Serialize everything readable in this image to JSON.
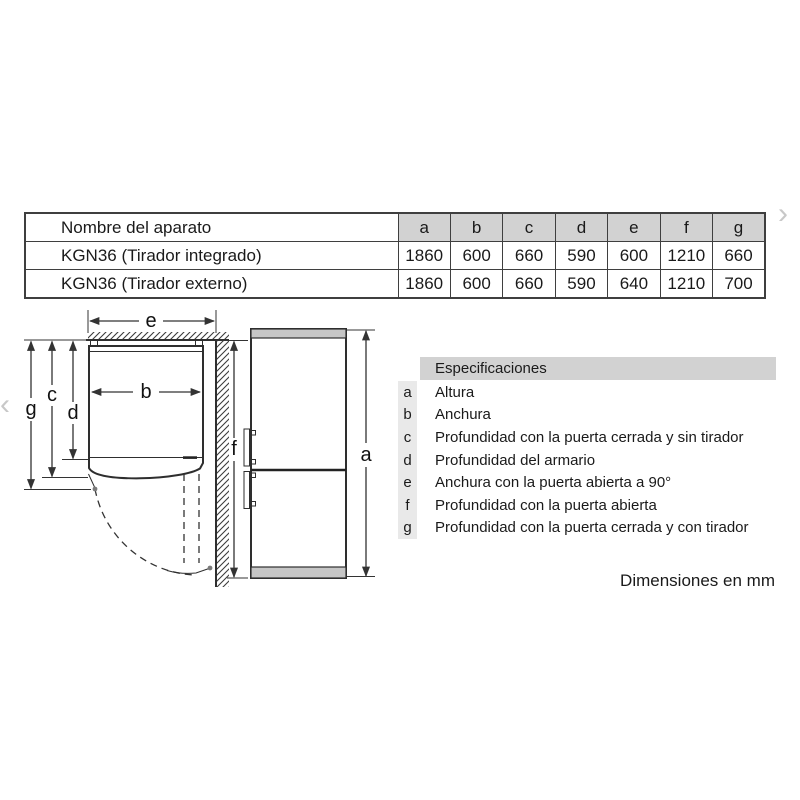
{
  "table": {
    "name_header": "Nombre del aparato",
    "dim_headers": [
      "a",
      "b",
      "c",
      "d",
      "e",
      "f",
      "g"
    ],
    "rows": [
      {
        "name": "KGN36 (Tirador integrado)",
        "values": [
          "1860",
          "600",
          "660",
          "590",
          "600",
          "1210",
          "660"
        ]
      },
      {
        "name": "KGN36 (Tirador externo)",
        "values": [
          "1860",
          "600",
          "660",
          "590",
          "640",
          "1210",
          "700"
        ]
      }
    ]
  },
  "specs": {
    "header": "Especificaciones",
    "items": [
      {
        "key": "a",
        "label": "Altura"
      },
      {
        "key": "b",
        "label": "Anchura"
      },
      {
        "key": "c",
        "label": "Profundidad con la puerta cerrada y sin tirador"
      },
      {
        "key": "d",
        "label": "Profundidad del armario"
      },
      {
        "key": "e",
        "label": "Anchura con la puerta abierta a 90°"
      },
      {
        "key": "f",
        "label": "Profundidad con la puerta abierta"
      },
      {
        "key": "g",
        "label": "Profundidad con la puerta cerrada y con tirador"
      }
    ]
  },
  "diagram": {
    "labels": {
      "a": "a",
      "b": "b",
      "c": "c",
      "d": "d",
      "e": "e",
      "f": "f",
      "g": "g"
    }
  },
  "footer": {
    "units_note": "Dimensiones en mm"
  },
  "carousel": {
    "prev_icon": "‹",
    "next_icon": "›"
  },
  "colors": {
    "table_header_bg": "#d2d2d2",
    "spec_key_bg": "#e9e9e9",
    "fridge_band": "#c6c6c6",
    "line": "#333333",
    "text": "#1a1a1a",
    "chevron": "#c8c8c8"
  }
}
